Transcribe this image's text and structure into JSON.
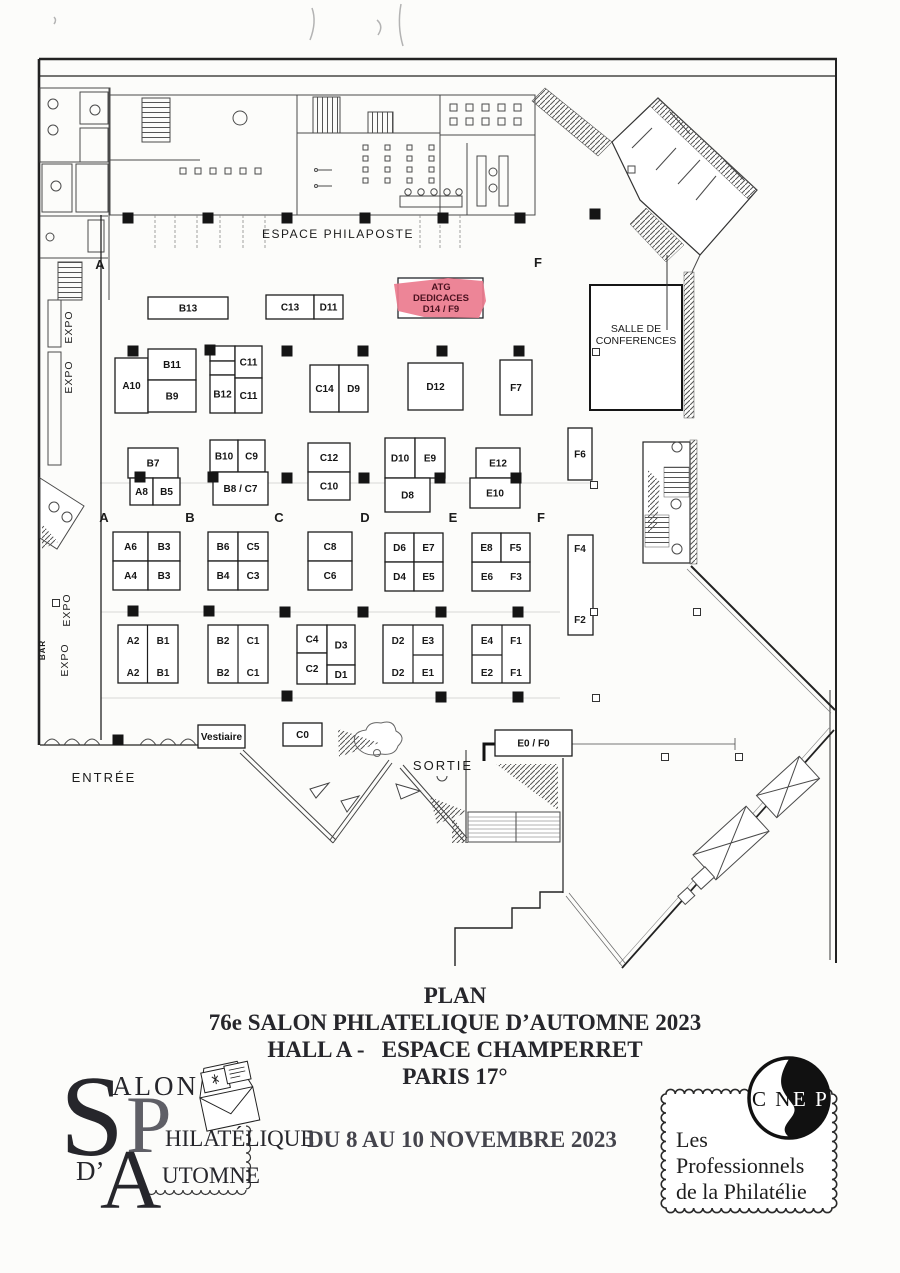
{
  "title_block": {
    "line1": "PLAN",
    "line2": "76e SALON PHLATELIQUE D’AUTOMNE 2023",
    "line3": "HALL A -   ESPACE CHAMPERRET",
    "line4": "PARIS 17°",
    "dates": "DU 8 AU 10 NOVEMBRE 2023"
  },
  "logos": {
    "salon": {
      "cap1": "S",
      "rest1": "ALON",
      "cap2": "P",
      "rest2": "HILATÉLIQUE",
      "prefix": "D’",
      "cap3": "A",
      "rest3": "UTOMNE"
    },
    "cnep": {
      "abbr_left": "C N",
      "abbr_right": "E P",
      "line1": "Les",
      "line2": "Professionnels",
      "line3": "de la Philatélie"
    }
  },
  "plan": {
    "highlight": {
      "x": 398,
      "y": 278,
      "w": 85,
      "h": 40,
      "fill": "#ec7b8e",
      "stroke": "#23262b",
      "text_color": "#4b1220",
      "lines": [
        "ATG",
        "DEDICACES",
        "D14 / F9"
      ]
    },
    "booths": [
      {
        "l": "B13",
        "x": 148,
        "y": 297,
        "w": 80,
        "h": 22
      },
      {
        "l": "C13",
        "x": 266,
        "y": 295,
        "w": 48,
        "h": 24
      },
      {
        "l": "D11",
        "x": 314,
        "y": 295,
        "w": 29,
        "h": 24
      },
      {
        "l": "A10",
        "x": 115,
        "y": 358,
        "w": 33,
        "h": 55
      },
      {
        "l": "B11",
        "x": 148,
        "y": 349,
        "w": 48,
        "h": 31
      },
      {
        "l": "B9",
        "x": 148,
        "y": 380,
        "w": 48,
        "h": 32
      },
      {
        "l": "B12",
        "x": 210,
        "y": 375,
        "w": 25,
        "h": 38
      },
      {
        "l": "C11",
        "x": 235,
        "y": 346,
        "w": 27,
        "h": 32
      },
      {
        "l": "C11",
        "x": 235,
        "y": 378,
        "w": 27,
        "h": 35
      },
      {
        "l": "C14",
        "x": 310,
        "y": 365,
        "w": 29,
        "h": 47
      },
      {
        "l": "D9",
        "x": 339,
        "y": 365,
        "w": 29,
        "h": 47
      },
      {
        "l": "D12",
        "x": 408,
        "y": 363,
        "w": 55,
        "h": 47
      },
      {
        "l": "F7",
        "x": 500,
        "y": 360,
        "w": 32,
        "h": 55
      },
      {
        "l": "B7",
        "x": 128,
        "y": 448,
        "w": 50,
        "h": 30
      },
      {
        "l": "A8",
        "x": 130,
        "y": 478,
        "w": 23,
        "h": 27
      },
      {
        "l": "B5",
        "x": 153,
        "y": 478,
        "w": 27,
        "h": 27
      },
      {
        "l": "B10",
        "x": 210,
        "y": 440,
        "w": 28,
        "h": 32
      },
      {
        "l": "C9",
        "x": 238,
        "y": 440,
        "w": 27,
        "h": 32
      },
      {
        "l": "B8 / C7",
        "x": 213,
        "y": 472,
        "w": 55,
        "h": 33
      },
      {
        "l": "C12",
        "x": 308,
        "y": 443,
        "w": 42,
        "h": 29
      },
      {
        "l": "C10",
        "x": 308,
        "y": 472,
        "w": 42,
        "h": 28
      },
      {
        "l": "D10",
        "x": 385,
        "y": 438,
        "w": 30,
        "h": 40
      },
      {
        "l": "E9",
        "x": 415,
        "y": 438,
        "w": 30,
        "h": 40
      },
      {
        "l": "D8",
        "x": 385,
        "y": 478,
        "w": 45,
        "h": 34
      },
      {
        "l": "E12",
        "x": 476,
        "y": 448,
        "w": 44,
        "h": 30
      },
      {
        "l": "E10",
        "x": 470,
        "y": 478,
        "w": 50,
        "h": 30
      },
      {
        "l": "F6",
        "x": 568,
        "y": 428,
        "w": 24,
        "h": 52
      },
      {
        "l": "A6",
        "x": 113,
        "y": 532,
        "w": 35,
        "h": 29
      },
      {
        "l": "B3",
        "x": 148,
        "y": 532,
        "w": 32,
        "h": 29
      },
      {
        "l": "A4",
        "x": 113,
        "y": 561,
        "w": 35,
        "h": 29
      },
      {
        "l": "B3",
        "x": 148,
        "y": 561,
        "w": 32,
        "h": 29
      },
      {
        "l": "B6",
        "x": 208,
        "y": 532,
        "w": 30,
        "h": 29
      },
      {
        "l": "C5",
        "x": 238,
        "y": 532,
        "w": 30,
        "h": 29
      },
      {
        "l": "B4",
        "x": 208,
        "y": 561,
        "w": 30,
        "h": 29
      },
      {
        "l": "C3",
        "x": 238,
        "y": 561,
        "w": 30,
        "h": 29
      },
      {
        "l": "C8",
        "x": 308,
        "y": 532,
        "w": 44,
        "h": 29
      },
      {
        "l": "C6",
        "x": 308,
        "y": 561,
        "w": 44,
        "h": 29
      },
      {
        "l": "D6",
        "x": 385,
        "y": 533,
        "w": 29,
        "h": 29
      },
      {
        "l": "E7",
        "x": 414,
        "y": 533,
        "w": 29,
        "h": 29
      },
      {
        "l": "D4",
        "x": 385,
        "y": 562,
        "w": 29,
        "h": 29
      },
      {
        "l": "E5",
        "x": 414,
        "y": 562,
        "w": 29,
        "h": 29
      },
      {
        "l": "E8",
        "x": 472,
        "y": 533,
        "w": 29,
        "h": 29
      },
      {
        "l": "F5",
        "x": 501,
        "y": 533,
        "w": 29,
        "h": 29
      },
      {
        "l": "C4",
        "x": 297,
        "y": 625,
        "w": 30,
        "h": 28
      },
      {
        "l": "C2",
        "x": 297,
        "y": 653,
        "w": 30,
        "h": 31
      },
      {
        "l": "D3",
        "x": 327,
        "y": 625,
        "w": 28,
        "h": 40
      },
      {
        "l": "D1",
        "x": 327,
        "y": 665,
        "w": 28,
        "h": 19
      },
      {
        "l": "Vestiaire",
        "x": 198,
        "y": 725,
        "w": 47,
        "h": 23,
        "fs": 8.5
      },
      {
        "l": "C0",
        "x": 283,
        "y": 723,
        "w": 39,
        "h": 23
      },
      {
        "l": "E0 / F0",
        "x": 495,
        "y": 730,
        "w": 77,
        "h": 26
      }
    ],
    "extra_rects": [
      {
        "x": 210,
        "y": 346,
        "w": 25,
        "h": 15
      },
      {
        "x": 210,
        "y": 361,
        "w": 25,
        "h": 14
      },
      {
        "x": 472,
        "y": 562,
        "w": 58,
        "h": 29
      },
      {
        "x": 568,
        "y": 535,
        "w": 25,
        "h": 100
      },
      {
        "x": 118,
        "y": 625,
        "w": 60,
        "h": 58
      },
      {
        "x": 208,
        "y": 625,
        "w": 60,
        "h": 58
      },
      {
        "x": 383,
        "y": 625,
        "w": 60,
        "h": 58
      },
      {
        "x": 472,
        "y": 625,
        "w": 58,
        "h": 58
      }
    ],
    "divider_lines": [
      [
        147.5,
        625,
        147.5,
        683
      ],
      [
        238,
        625,
        238,
        683
      ],
      [
        413,
        625,
        413,
        683
      ],
      [
        413,
        655,
        443,
        655
      ],
      [
        502,
        625,
        502,
        683
      ],
      [
        472,
        655,
        502,
        655
      ]
    ],
    "labels": [
      {
        "t": "ESPACE PHILAPOSTE",
        "x": 338,
        "y": 238,
        "s": 12,
        "ls": 1.5
      },
      {
        "t": "SALLE DE",
        "x": 636,
        "y": 332,
        "s": 10.5
      },
      {
        "t": "CONFERENCES",
        "x": 636,
        "y": 344,
        "s": 10.5
      },
      {
        "t": "A",
        "x": 100,
        "y": 269,
        "s": 13,
        "b": 1
      },
      {
        "t": "F",
        "x": 538,
        "y": 267,
        "s": 13,
        "b": 1
      },
      {
        "t": "A",
        "x": 104,
        "y": 522,
        "s": 13,
        "b": 1
      },
      {
        "t": "B",
        "x": 190,
        "y": 522,
        "s": 13,
        "b": 1
      },
      {
        "t": "C",
        "x": 279,
        "y": 522,
        "s": 13,
        "b": 1
      },
      {
        "t": "D",
        "x": 365,
        "y": 522,
        "s": 13,
        "b": 1
      },
      {
        "t": "E",
        "x": 453,
        "y": 522,
        "s": 13,
        "b": 1
      },
      {
        "t": "F",
        "x": 541,
        "y": 522,
        "s": 13,
        "b": 1
      },
      {
        "t": "ENTRÉE",
        "x": 104,
        "y": 782,
        "s": 13,
        "ls": 2
      },
      {
        "t": "SORTIE",
        "x": 443,
        "y": 770,
        "s": 13,
        "ls": 2
      },
      {
        "t": "EXPO",
        "x": 72,
        "y": 327,
        "s": 10.5,
        "rot": -90,
        "ls": 1
      },
      {
        "t": "EXPO",
        "x": 72,
        "y": 377,
        "s": 10.5,
        "rot": -90,
        "ls": 1
      },
      {
        "t": "EXPO",
        "x": 70,
        "y": 610,
        "s": 10.5,
        "rot": -90,
        "ls": 1
      },
      {
        "t": "EXPO",
        "x": 68,
        "y": 660,
        "s": 10.5,
        "rot": -90,
        "ls": 1
      },
      {
        "t": "BAR",
        "x": 45,
        "y": 650,
        "s": 8,
        "b": 1,
        "rot": -90,
        "ls": 1
      },
      {
        "t": "E6",
        "x": 487,
        "y": 580,
        "s": 10,
        "b": 1
      },
      {
        "t": "F3",
        "x": 516,
        "y": 580,
        "s": 10,
        "b": 1
      },
      {
        "t": "F4",
        "x": 580,
        "y": 552,
        "s": 10,
        "b": 1
      },
      {
        "t": "F2",
        "x": 580,
        "y": 623,
        "s": 10,
        "b": 1
      },
      {
        "t": "A2",
        "x": 133,
        "y": 644,
        "s": 10,
        "b": 1
      },
      {
        "t": "B1",
        "x": 163,
        "y": 644,
        "s": 10,
        "b": 1
      },
      {
        "t": "A2",
        "x": 133,
        "y": 676,
        "s": 10,
        "b": 1
      },
      {
        "t": "B1",
        "x": 163,
        "y": 676,
        "s": 10,
        "b": 1
      },
      {
        "t": "B2",
        "x": 223,
        "y": 644,
        "s": 10,
        "b": 1
      },
      {
        "t": "C1",
        "x": 253,
        "y": 644,
        "s": 10,
        "b": 1
      },
      {
        "t": "B2",
        "x": 223,
        "y": 676,
        "s": 10,
        "b": 1
      },
      {
        "t": "C1",
        "x": 253,
        "y": 676,
        "s": 10,
        "b": 1
      },
      {
        "t": "D2",
        "x": 398,
        "y": 644,
        "s": 10,
        "b": 1
      },
      {
        "t": "E3",
        "x": 428,
        "y": 644,
        "s": 10,
        "b": 1
      },
      {
        "t": "D2",
        "x": 398,
        "y": 676,
        "s": 10,
        "b": 1
      },
      {
        "t": "E1",
        "x": 428,
        "y": 676,
        "s": 10,
        "b": 1
      },
      {
        "t": "E4",
        "x": 487,
        "y": 644,
        "s": 10,
        "b": 1
      },
      {
        "t": "F1",
        "x": 516,
        "y": 644,
        "s": 10,
        "b": 1
      },
      {
        "t": "E2",
        "x": 487,
        "y": 676,
        "s": 10,
        "b": 1
      },
      {
        "t": "F1",
        "x": 516,
        "y": 676,
        "s": 10,
        "b": 1
      }
    ],
    "pillars_filled": [
      [
        128,
        218
      ],
      [
        208,
        218
      ],
      [
        287,
        218
      ],
      [
        365,
        218
      ],
      [
        443,
        218
      ],
      [
        520,
        218
      ],
      [
        595,
        214
      ],
      [
        133,
        351
      ],
      [
        210,
        350
      ],
      [
        287,
        351
      ],
      [
        363,
        351
      ],
      [
        442,
        351
      ],
      [
        519,
        351
      ],
      [
        140,
        477
      ],
      [
        213,
        477
      ],
      [
        287,
        478
      ],
      [
        364,
        478
      ],
      [
        440,
        478
      ],
      [
        516,
        478
      ],
      [
        133,
        611
      ],
      [
        209,
        611
      ],
      [
        285,
        612
      ],
      [
        363,
        612
      ],
      [
        441,
        612
      ],
      [
        518,
        612
      ],
      [
        287,
        696
      ],
      [
        441,
        697
      ],
      [
        518,
        697
      ],
      [
        118,
        740
      ]
    ],
    "pillars_open": [
      [
        594,
        485
      ],
      [
        594,
        612
      ],
      [
        596,
        698
      ],
      [
        697,
        612
      ],
      [
        665,
        757
      ],
      [
        739,
        757
      ],
      [
        56,
        603
      ],
      [
        596,
        352
      ]
    ]
  }
}
